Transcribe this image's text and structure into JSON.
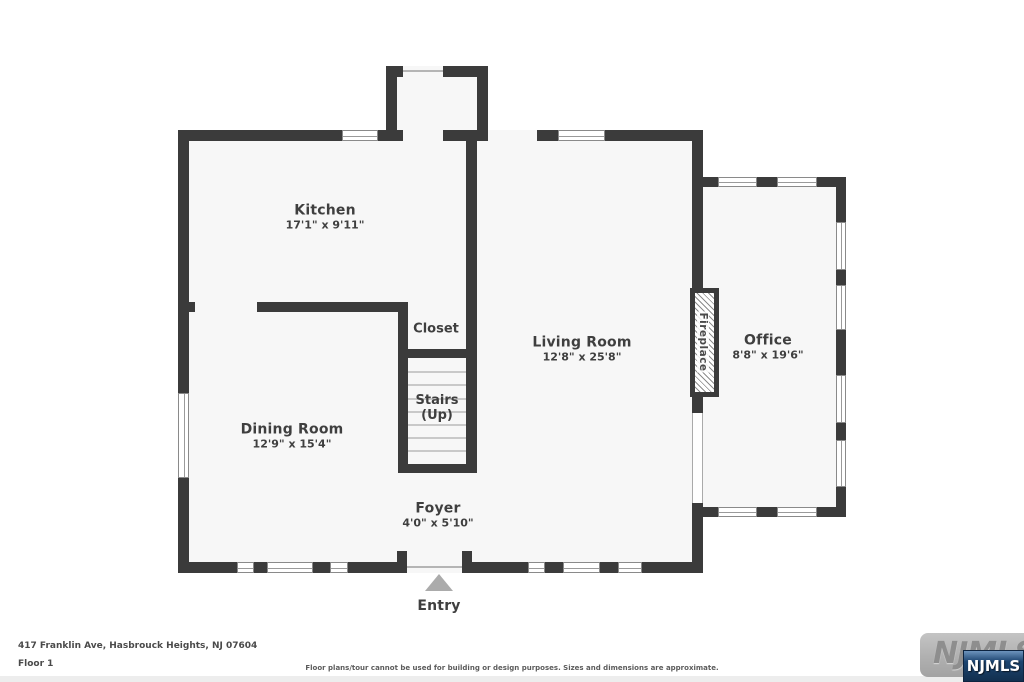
{
  "rooms": {
    "kitchen": {
      "name": "Kitchen",
      "dims": "17'1\" x 9'11\""
    },
    "living": {
      "name": "Living Room",
      "dims": "12'8\" x 25'8\""
    },
    "office": {
      "name": "Office",
      "dims": "8'8\" x 19'6\""
    },
    "dining": {
      "name": "Dining Room",
      "dims": "12'9\" x 15'4\""
    },
    "foyer": {
      "name": "Foyer",
      "dims": "4'0\" x 5'10\""
    },
    "closet": {
      "name": "Closet"
    },
    "stairs": {
      "line1": "Stairs",
      "line2": "(Up)"
    },
    "fireplace": {
      "name": "Fireplace"
    },
    "entry": {
      "name": "Entry"
    }
  },
  "footer": {
    "address": "417 Franklin Ave, Hasbrouck Heights, NJ 07604",
    "floor_label": "Floor 1",
    "disclaimer": "Floor plans/tour cannot be used for building or design purposes. Sizes and dimensions are approximate."
  },
  "logo": {
    "watermark_text": "NJMLS",
    "badge_text": "NJMLS"
  },
  "colors": {
    "wall": "#3b3b3b",
    "room_fill": "#f7f7f7",
    "label_text": "#3f3f3f",
    "entry_marker": "#ababab",
    "logo_badge_blue": "#1c4470",
    "logo_watermark_gray": "#b0b0b0"
  }
}
